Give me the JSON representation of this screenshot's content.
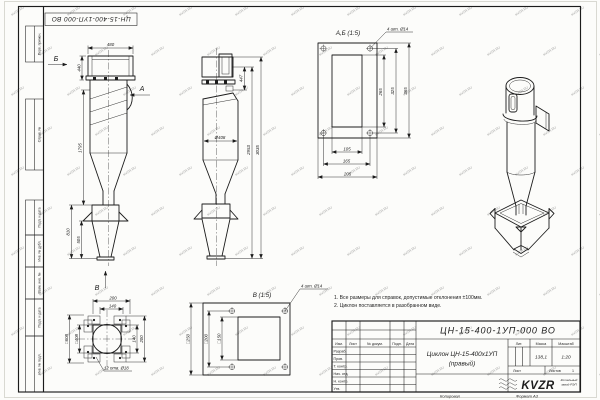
{
  "sheet": {
    "doc_number_top": "ЦН-15-400-1УП-000 ВО",
    "left_strips": [
      "Перв. примен.",
      "Справ. №",
      "Подп. и дата",
      "Инв. № дубл.",
      "Взам. инв. №",
      "Подп. и дата",
      "Инв. № подл."
    ],
    "watermark": "KVZR.RU"
  },
  "notes": [
    "1. Все размеры для справок, допустимые отклонения ±100мм.",
    "2. Циклон поставляется в разобранном виде."
  ],
  "views": {
    "front": {
      "label_a": "А",
      "label_b": "Б",
      "label_v": "В",
      "w480": "480",
      "h440": "440",
      "h1795": "1795",
      "h810": "810",
      "h505": "505"
    },
    "section": {
      "d408": "Ø408",
      "h447": "447",
      "h2953": "2953",
      "h3035": "3035"
    },
    "flange_ab": {
      "title": "А,Б (1:5)",
      "holes": "4 шт. Ø14",
      "v265": "265",
      "v325": "325",
      "v365": "365",
      "v105": "105",
      "v165": "165",
      "v205": "205"
    },
    "base": {
      "holes": "12 отв. Ø18",
      "w200": "200",
      "w140": "140",
      "h140": "140",
      "h200": "200",
      "sq608": "□608",
      "sq408": "□408"
    },
    "flange_v": {
      "title": "В (1:5)",
      "holes": "4 шт. Ø14",
      "s250": "□250",
      "s200": "□200",
      "s150": "□150"
    }
  },
  "title_block": {
    "doc_number": "ЦН-15-400-1УП-000 ВО",
    "name_line1": "Циклон ЦН-15-400х1УП",
    "name_line2": "(правый)",
    "header_cols": [
      "Изм.",
      "Лист",
      "№ докум.",
      "Подп.",
      "Дата"
    ],
    "rows": [
      "Разраб.",
      "Пров.",
      "Т. контр.",
      "Нач. отд.",
      "Н. контр.",
      "Утв."
    ],
    "lit_label": "Лит.",
    "mass_label": "Масса",
    "scale_label": "Масштаб",
    "mass": "138,1",
    "scale": "1:20",
    "sheet_label": "Лист",
    "sheets_label": "Листов",
    "sheets_value": "1",
    "logo": "KVZR",
    "logo_caption1": "Котельный",
    "logo_caption2": "завод РЭП",
    "copied": "Копировал",
    "format": "Формат А3"
  },
  "colors": {
    "line": "#1c1c1c",
    "paper": "#fcfcfa",
    "watermark": "#8fa3b0"
  }
}
